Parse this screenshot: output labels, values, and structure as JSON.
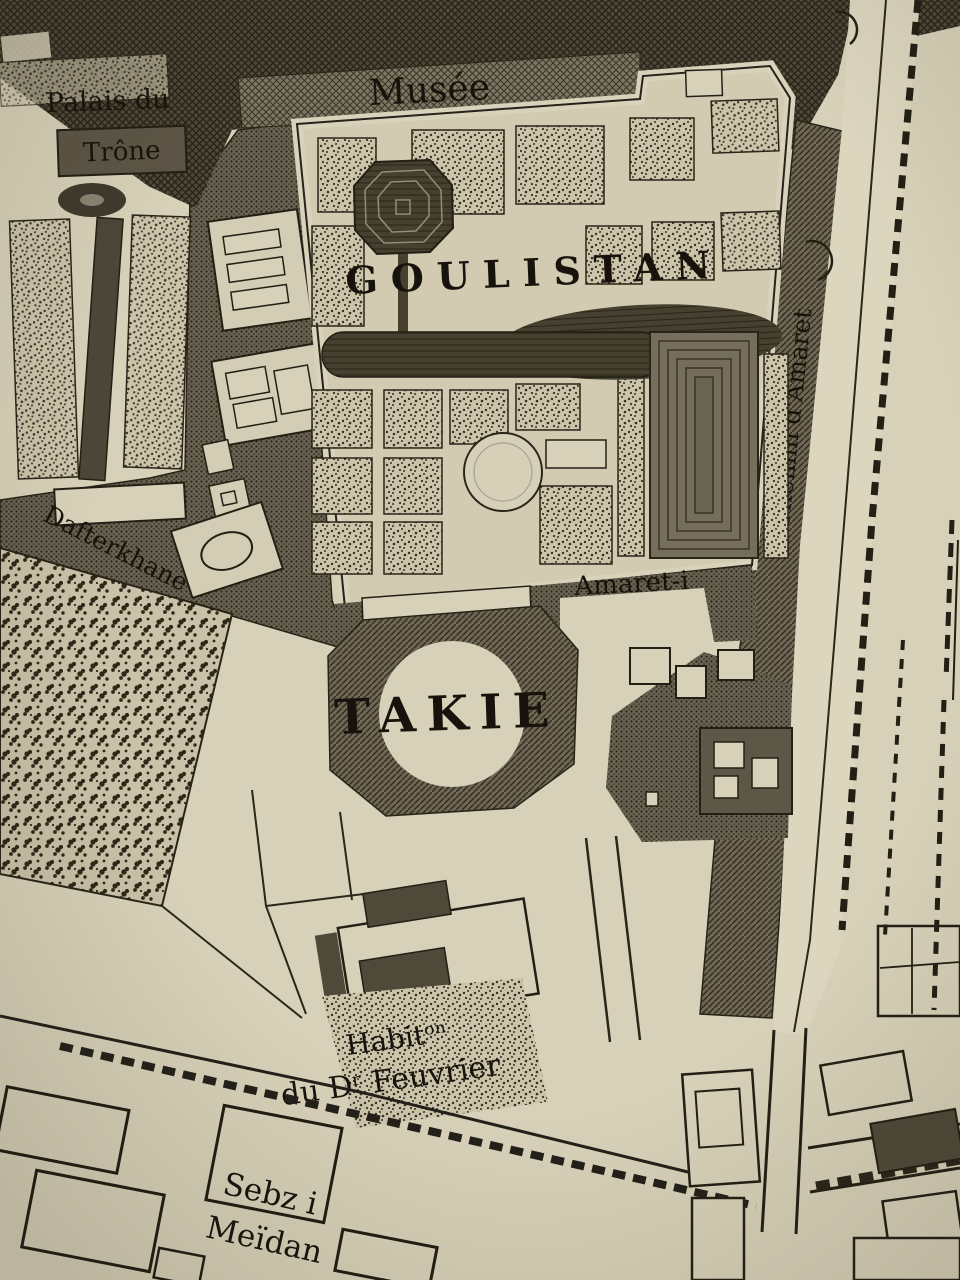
{
  "labels": {
    "palais_line1": "Palais du",
    "palais_line2": "Trône",
    "musee": "Musée",
    "goulistan": "GOULISTAN",
    "chemin_amaret": "Chemin d'Amaret",
    "dafterkhane": "Dafterkhane",
    "amaret_line1": "Amaret-i",
    "amaret_line2": "Badghir",
    "takie": "TAKIE",
    "habitation_line1": "Habitᵒⁿ",
    "habitation_line2": "du Dʳ Feuvrier",
    "sebz_line1": "Sebz i",
    "sebz_line2": "Meïdan"
  },
  "colors": {
    "paper": "#d8d1b9",
    "paper_light": "#ddd6bf",
    "garden_base": "#d2cbb2",
    "ink": "#17130c",
    "dark_block": "#4e4839",
    "mid_dark": "#6a6353",
    "pond_dark": "#45402f"
  }
}
